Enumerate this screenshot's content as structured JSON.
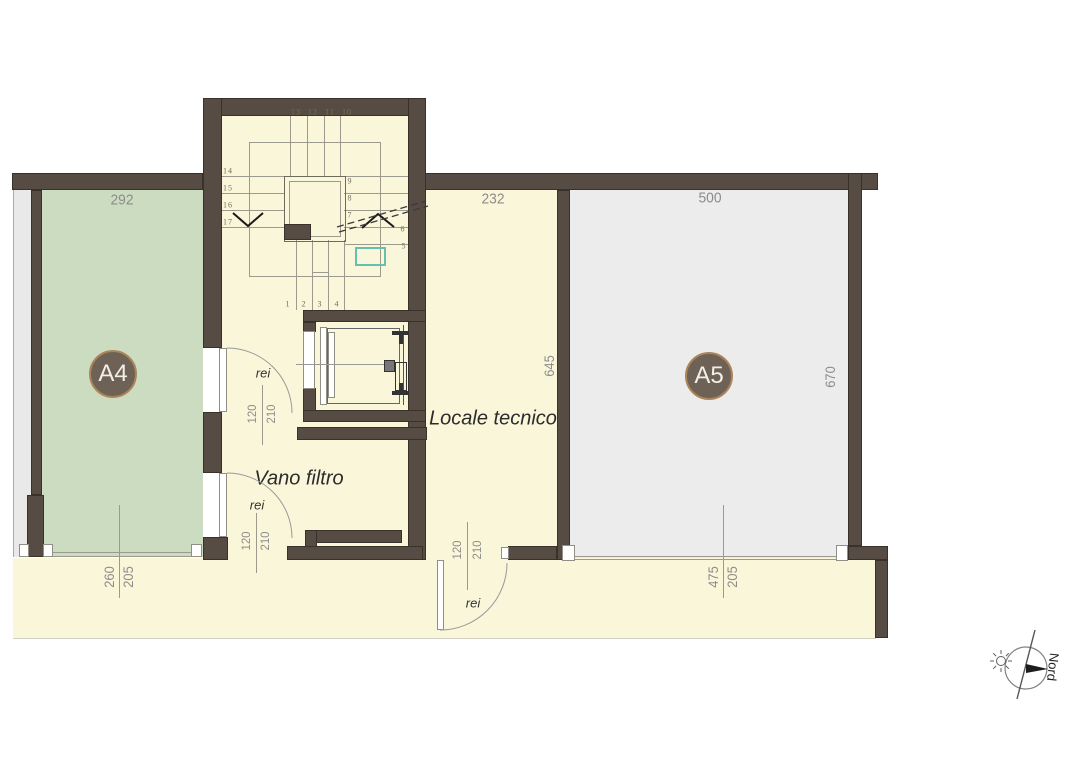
{
  "plan": {
    "rooms": {
      "a4": {
        "badge": "A4",
        "dim_width": "292",
        "opening": {
          "width": "260",
          "height": "205"
        }
      },
      "a5": {
        "badge": "A5",
        "dim_width": "500",
        "dim_depth": "670",
        "opening": {
          "width": "475",
          "height": "205"
        }
      },
      "locale_tecnico": {
        "label": "Locale tecnico",
        "dim_width": "232",
        "dim_depth": "645"
      },
      "vano_filtro": {
        "label": "Vano filtro"
      }
    },
    "doors": {
      "door_top": {
        "fire_rating": "rei",
        "width": "120",
        "height": "210"
      },
      "door_middle": {
        "fire_rating": "rei",
        "width": "120",
        "height": "210"
      },
      "door_bottom": {
        "fire_rating": "rei",
        "width": "120",
        "height": "210"
      }
    },
    "stairs": {
      "steps": [
        "1",
        "2",
        "3",
        "4",
        "5",
        "6",
        "7",
        "8",
        "9",
        "10",
        "11",
        "12",
        "13",
        "14",
        "15",
        "16",
        "17"
      ]
    },
    "compass": {
      "label": "Nord"
    },
    "colors": {
      "wall": "#564c44",
      "floor": "#faf6da",
      "room_a4": "#ccdcc1",
      "room_a5": "#ececec",
      "badge_fill": "#6e6257",
      "badge_border": "#ab8559",
      "equipment_teal": "#63c1ad"
    }
  }
}
